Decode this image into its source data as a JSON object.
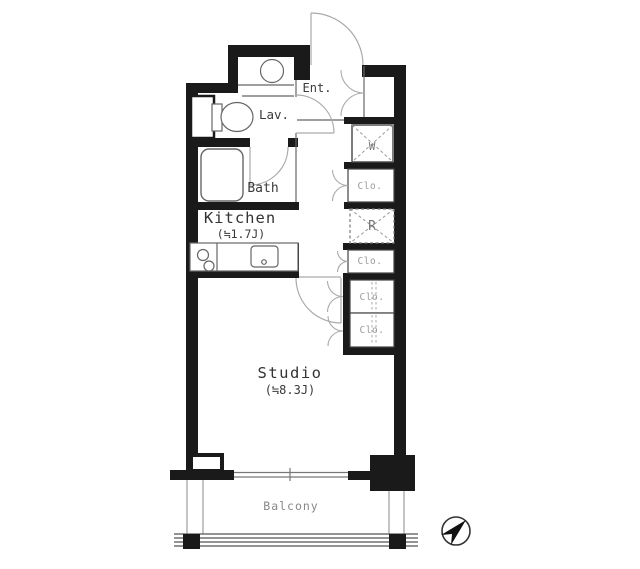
{
  "rooms": {
    "entrance": {
      "label": "Ent."
    },
    "lavatory": {
      "label": "Lav."
    },
    "bath": {
      "label": "Bath"
    },
    "kitchen": {
      "label": "Kitchen",
      "area": "(≒1.7J)"
    },
    "studio": {
      "label": "Studio",
      "area": "(≒8.3J)"
    },
    "balcony": {
      "label": "Balcony"
    }
  },
  "fixtures": {
    "washer": {
      "label": "W"
    },
    "refrigerator": {
      "label": "R"
    },
    "closets": [
      {
        "label": "Clo."
      },
      {
        "label": "Clo."
      },
      {
        "label": "Clo."
      },
      {
        "label": "Clo."
      }
    ]
  },
  "colors": {
    "wall": "#1a1a1a",
    "fixture_line": "#666666",
    "door_arc": "#aaaaaa",
    "label_dark": "#333333",
    "label_muted": "#9a9a9a"
  }
}
